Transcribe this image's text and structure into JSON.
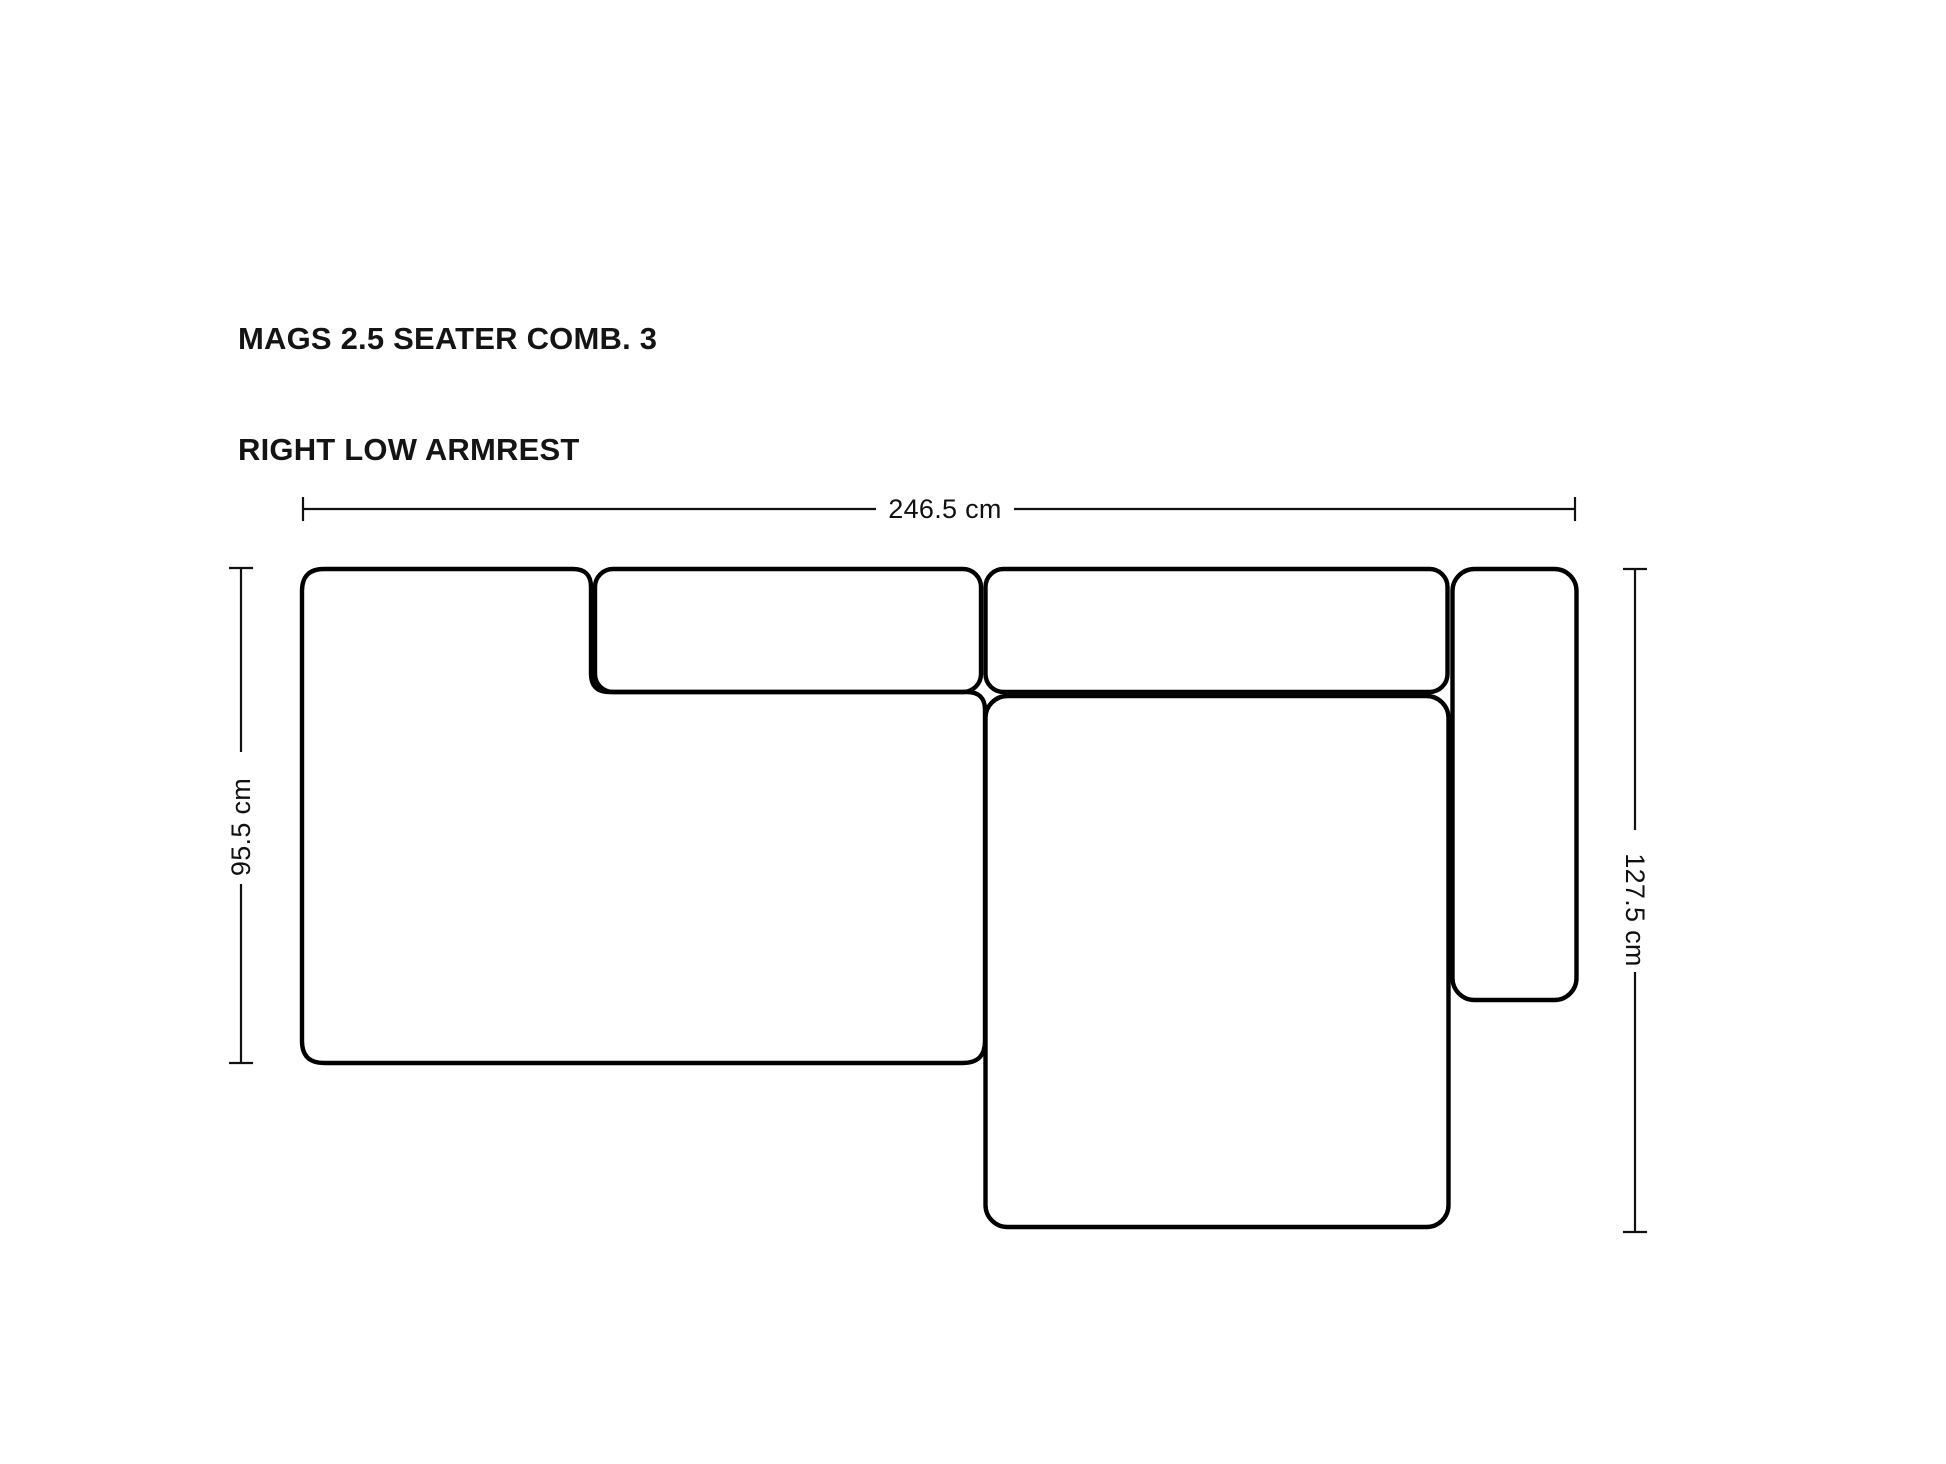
{
  "title": {
    "line1": "MAGS 2.5 SEATER COMB. 3",
    "line2": "RIGHT LOW ARMREST"
  },
  "dimensions": {
    "total_width": "246.5 cm",
    "left_depth": "95.5 cm",
    "right_depth": "127.5 cm"
  },
  "diagram": {
    "type": "sofa-top-view-dimension-drawing",
    "modules": [
      "left-seat-module",
      "back-cushion-left",
      "back-cushion-right",
      "chaise-module",
      "right-low-armrest"
    ]
  },
  "colors": {
    "background": "#ffffff",
    "outline": "#000000",
    "text": "#141414"
  }
}
